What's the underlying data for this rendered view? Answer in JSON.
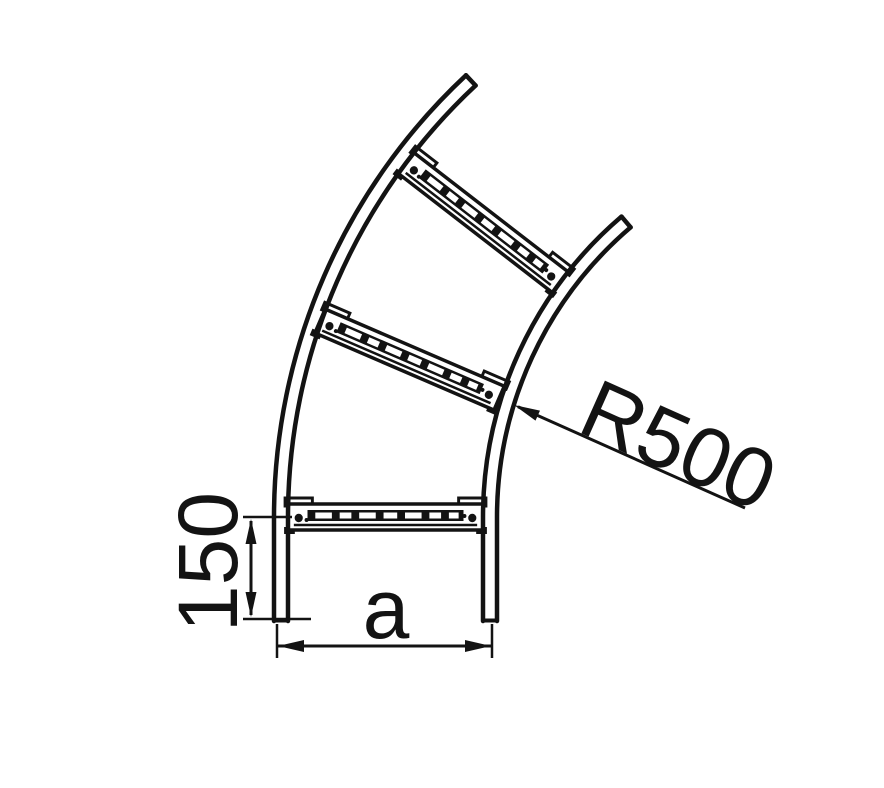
{
  "drawing": {
    "labels": {
      "radius": "R500",
      "tangent_length": "150",
      "width": "a"
    },
    "colors": {
      "line": "#131313",
      "background": "#ffffff"
    }
  }
}
